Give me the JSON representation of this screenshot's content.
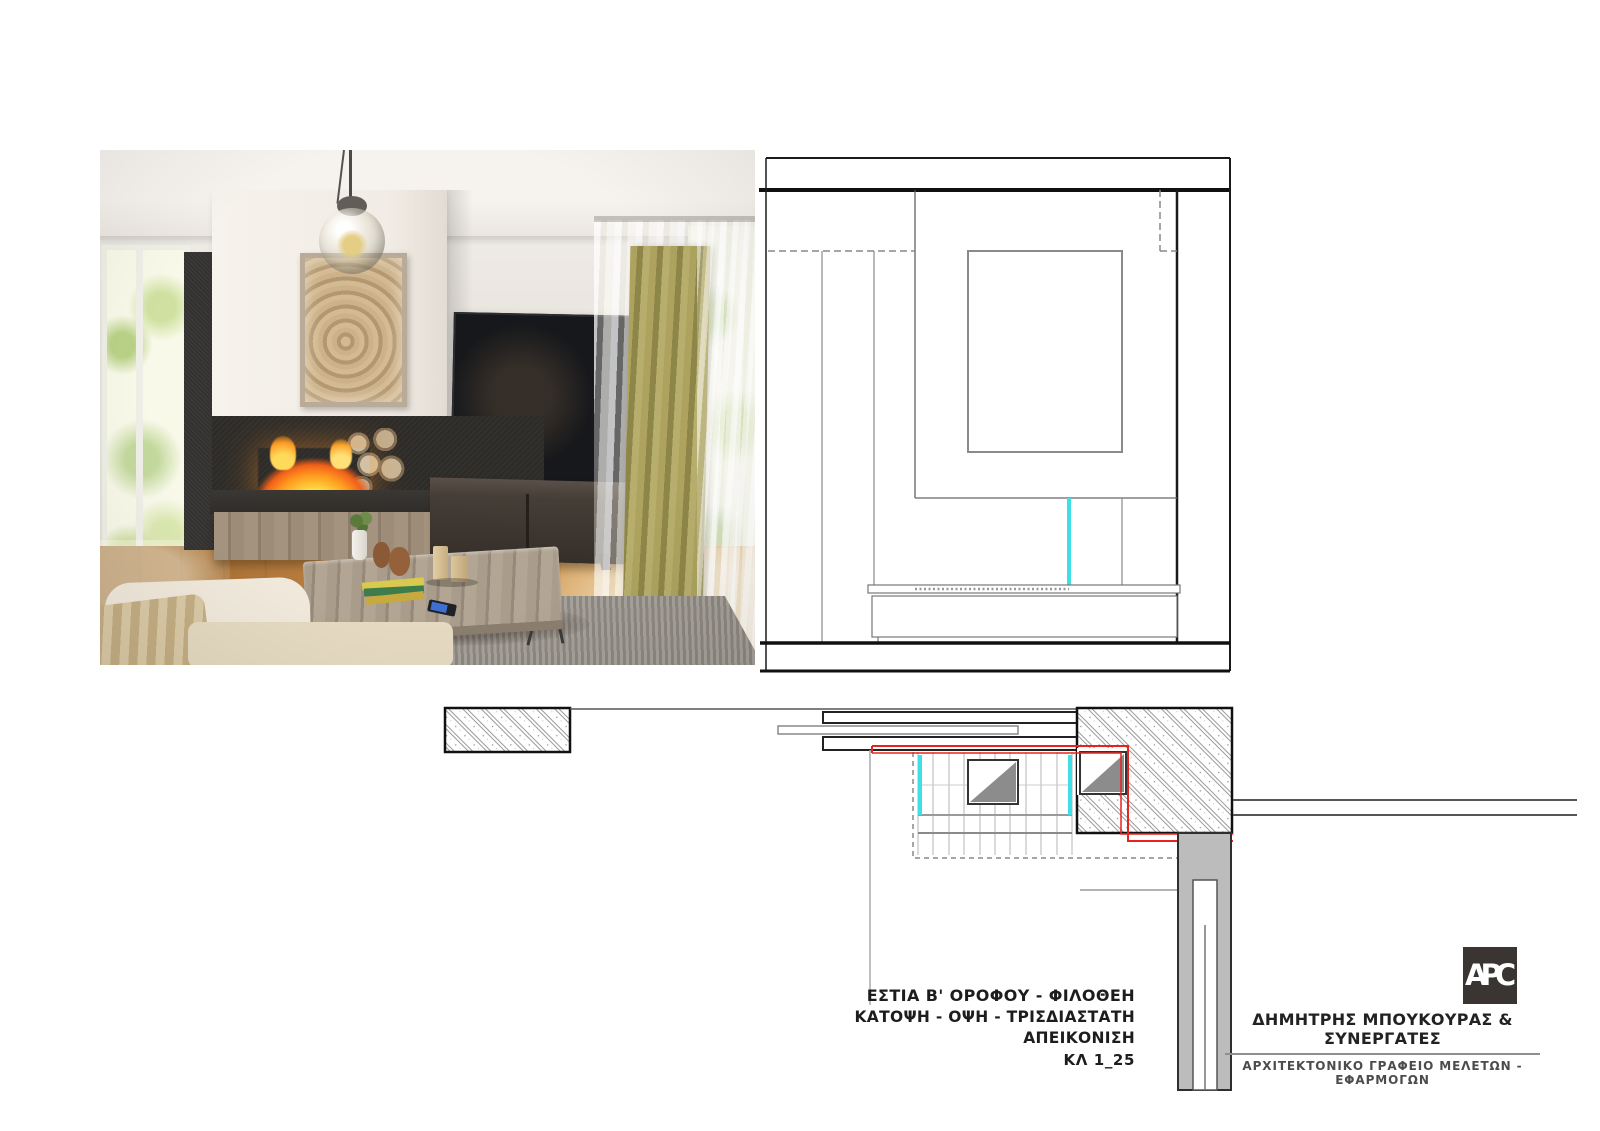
{
  "title_block": {
    "line1": "ΕΣΤΙΑ Β' ΟΡΟΦΟΥ - ΦΙΛΟΘΕΗ",
    "line2": "ΚΑΤΟΨΗ  - ΟΨΗ - ΤΡΙΣΔΙΑΣΤΑΤΗ ΑΠΕΙΚΟΝΙΣΗ",
    "line3": "ΚΛ 1_25"
  },
  "firm_block": {
    "logo_text": "APC",
    "name": "ΔΗΜΗΤΡΗΣ ΜΠΟΥΚΟΥΡΑΣ & ΣΥΝΕΡΓΑΤΕΣ",
    "subtitle": "ΑΡΧΙΤΕΚΤΟΝΙΚΟ  ΓΡΑΦΕΙΟ  ΜΕΛΕΤΩΝ  -  ΕΦΑΡΜΟΓΩΝ"
  },
  "colors": {
    "section_cut_red": "#e8231e",
    "glass_cyan": "#3fdfe8",
    "line_dark": "#1a1a1a",
    "line_gray": "#888888",
    "logo_background": "#3a3532"
  }
}
